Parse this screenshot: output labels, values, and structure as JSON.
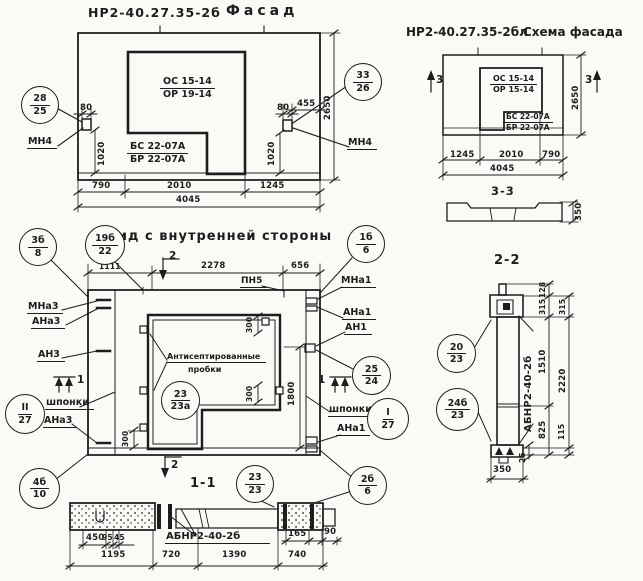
{
  "facade": {
    "code": "НР2-40.27.35-2б",
    "title": "Фасад",
    "win1": "ОС 15-14",
    "win2": "ОР 19-14",
    "pan1": "БС 22-07А",
    "pan2": "БР 22-07А",
    "mn4_left": "МН4",
    "mn4_right": "МН4",
    "bal_left": {
      "t": "28",
      "b": "25"
    },
    "bal_right": {
      "t": "33",
      "b": "26"
    },
    "d80l": "80",
    "d1020l": "1020",
    "d80r": "80",
    "d455": "455",
    "d1020r": "1020",
    "d2650": "2650",
    "d790": "790",
    "d2010": "2010",
    "d1245": "1245",
    "d4045": "4045"
  },
  "schema": {
    "code": "НР2-40.27.35-2бл",
    "title": "Схема фасада",
    "win1": "ОС 15-14",
    "win2": "ОР 15-14",
    "pan1": "БС 22-07А",
    "pan2": "БР 22-07А",
    "m3l": "3",
    "m3r": "3",
    "d1245": "1245",
    "d2010": "2010",
    "d790": "790",
    "d4045": "4045",
    "d2650": "2650"
  },
  "s33": {
    "title": "3-3",
    "d350": "350"
  },
  "inner": {
    "title": "Вид с внутренней стороны",
    "pn5": "ПН5",
    "note1": "Антисептированные",
    "note2": "пробки",
    "mna3": "МНа3",
    "ana3": "АНа3",
    "an3": "АН3",
    "ana3b": "АНа3",
    "mna1": "МНа1",
    "ana1": "АНа1",
    "an1": "АН1",
    "ana1b": "АНа1",
    "shponki_l": "шпонки",
    "shponki_r": "шпонки",
    "m2t": "2",
    "m2b": "2",
    "m1l": "1",
    "m1r": "1",
    "d1111": "1111",
    "d2278": "2278",
    "d656": "656",
    "d1800": "1800",
    "d300t": "300",
    "d300m": "300",
    "d300l": "300",
    "bal": {
      "b3b8": {
        "t": "3б",
        "b": "8"
      },
      "b19b22": {
        "t": "19б",
        "b": "22"
      },
      "b1b6": {
        "t": "1б",
        "b": "6"
      },
      "b25_24": {
        "t": "25",
        "b": "24"
      },
      "bI27": {
        "t": "I",
        "b": "27"
      },
      "bII27": {
        "t": "II",
        "b": "27"
      },
      "b23_23a": {
        "t": "23",
        "b": "23а"
      },
      "b4b10": {
        "t": "4б",
        "b": "10"
      },
      "b2b6": {
        "t": "2б",
        "b": "6"
      }
    }
  },
  "s11": {
    "title": "1-1",
    "label": "АБНР2-40-2б",
    "bal2323": {
      "t": "23",
      "b": "23"
    },
    "d450": "450",
    "d95": "95",
    "d45": "45",
    "d1195": "1195",
    "d720": "720",
    "d1390": "1390",
    "d740": "740",
    "d165": "165",
    "d90": "90"
  },
  "s22": {
    "title": "2-2",
    "label": "АБНР2-40-2б",
    "bal2023": {
      "t": "20",
      "b": "23"
    },
    "bal24b23": {
      "t": "24б",
      "b": "23"
    },
    "d128": "128",
    "d315a": "315",
    "d315b": "315",
    "d1510": "1510",
    "d2220": "2220",
    "d825": "825",
    "d115": "115",
    "d25": "25",
    "d350": "350"
  }
}
